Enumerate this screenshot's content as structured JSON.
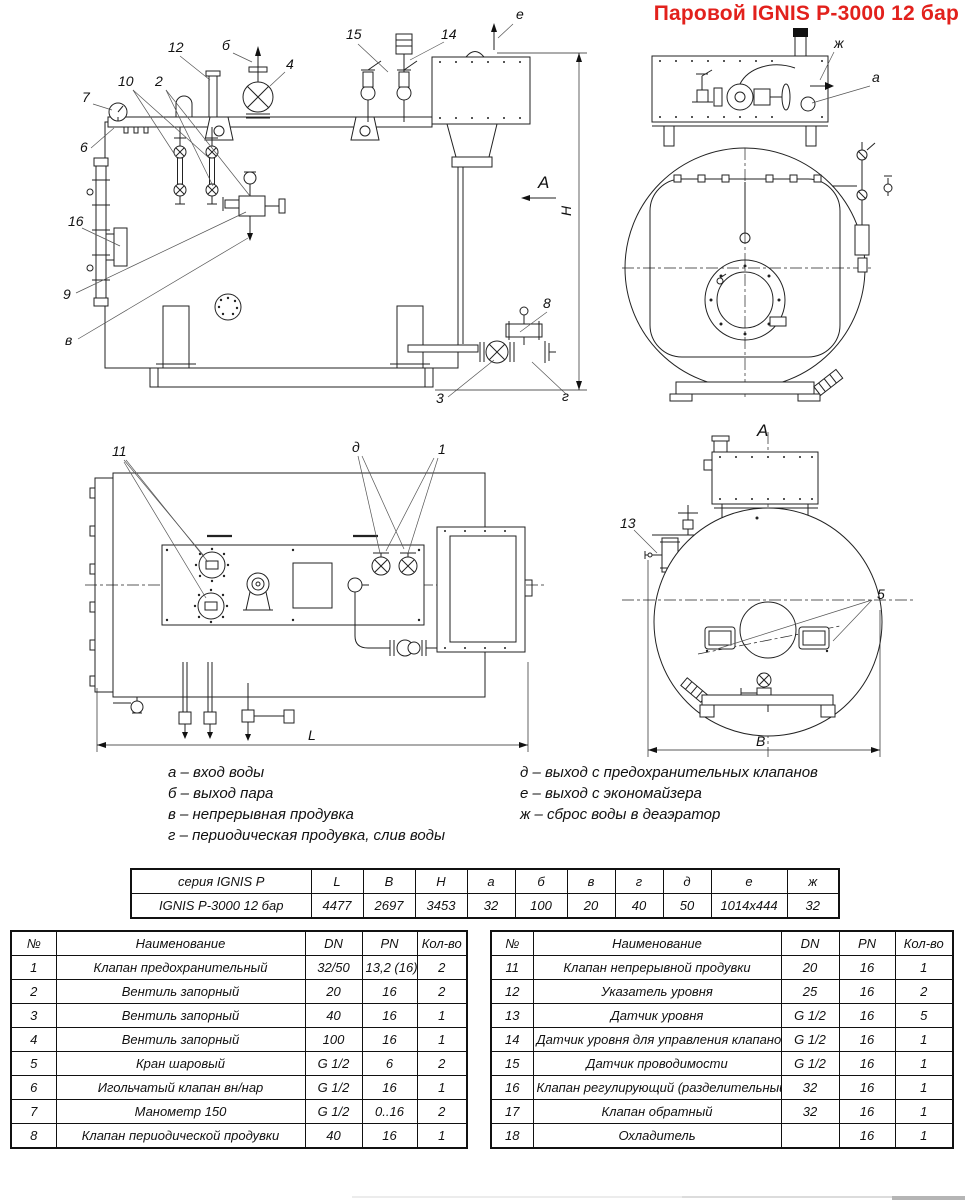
{
  "title": "Паровой IGNIS P-3000 12 бар",
  "callouts": {
    "side": {
      "n7": "7",
      "n6": "6",
      "n10": "10",
      "n12": "12",
      "n2": "2",
      "b": "б",
      "n4": "4",
      "n15": "15",
      "n14": "14",
      "e": "е",
      "n16": "16",
      "n9": "9",
      "v": "в",
      "n8": "8",
      "n3": "3",
      "g": "г",
      "sectionA": "А",
      "dimH": "H"
    },
    "front": {
      "zh": "ж",
      "a": "а"
    },
    "top": {
      "n11": "11",
      "d": "д",
      "n1": "1",
      "dimL": "L"
    },
    "rear": {
      "viewA": "А",
      "n13": "13",
      "n5": "5",
      "dimB": "В"
    }
  },
  "legend": {
    "left": [
      "а – вход воды",
      "б – выход пара",
      "в – непрерывная продувка",
      "г – периодическая продувка, слив воды"
    ],
    "right": [
      "д – выход с предохранительных клапанов",
      "е – выход с экономайзера",
      "ж – сброс воды в деаэратор"
    ]
  },
  "dim_table": {
    "header": [
      "серия IGNIS P",
      "L",
      "B",
      "H",
      "а",
      "б",
      "в",
      "г",
      "д",
      "е",
      "ж"
    ],
    "rows": [
      [
        "IGNIS P-3000 12 бар",
        "4477",
        "2697",
        "3453",
        "32",
        "100",
        "20",
        "40",
        "50",
        "1014x444",
        "32"
      ]
    ]
  },
  "parts_left": {
    "header": [
      "№",
      "Наименование",
      "DN",
      "PN",
      "Кол-во"
    ],
    "rows": [
      [
        "1",
        "Клапан предохранительный",
        "32/50",
        "13,2 (16)",
        "2"
      ],
      [
        "2",
        "Вентиль запорный",
        "20",
        "16",
        "2"
      ],
      [
        "3",
        "Вентиль запорный",
        "40",
        "16",
        "1"
      ],
      [
        "4",
        "Вентиль запорный",
        "100",
        "16",
        "1"
      ],
      [
        "5",
        "Кран шаровый",
        "G 1/2",
        "6",
        "2"
      ],
      [
        "6",
        "Игольчатый клапан вн/нар",
        "G 1/2",
        "16",
        "1"
      ],
      [
        "7",
        "Манометр 150",
        "G 1/2",
        "0..16",
        "2"
      ],
      [
        "8",
        "Клапан периодической продувки",
        "40",
        "16",
        "1"
      ]
    ]
  },
  "parts_right": {
    "header": [
      "№",
      "Наименование",
      "DN",
      "PN",
      "Кол-во"
    ],
    "rows": [
      [
        "11",
        "Клапан непрерывной продувки",
        "20",
        "16",
        "1"
      ],
      [
        "12",
        "Указатель уровня",
        "25",
        "16",
        "2"
      ],
      [
        "13",
        "Датчик уровня",
        "G 1/2",
        "16",
        "5"
      ],
      [
        "14",
        "Датчик уровня для управления клапаном",
        "G 1/2",
        "16",
        "1"
      ],
      [
        "15",
        "Датчик проводимости",
        "G 1/2",
        "16",
        "1"
      ],
      [
        "16",
        "Клапан регулирующий (разделительный)",
        "32",
        "16",
        "1"
      ],
      [
        "17",
        "Клапан обратный",
        "32",
        "16",
        "1"
      ],
      [
        "18",
        "Охладитель",
        "",
        "16",
        "1"
      ]
    ]
  }
}
